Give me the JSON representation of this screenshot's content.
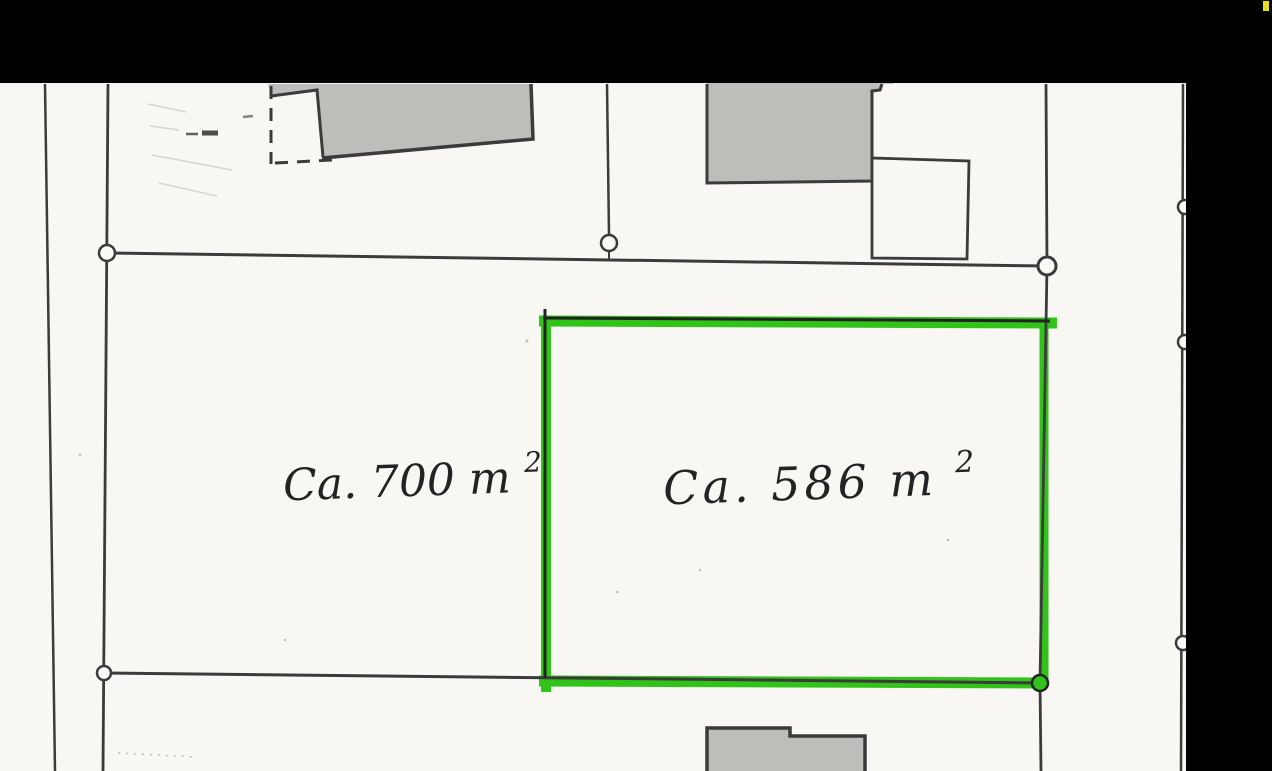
{
  "document": {
    "type_label": "Scanned cadastral site plan with highlighted parcel",
    "parcels": {
      "left": {
        "area_label": "Ca. 700 m",
        "area_sup": "2"
      },
      "right": {
        "area_label": "Ca. 586 m",
        "area_sup": "2",
        "highlighted": true
      }
    }
  },
  "colors": {
    "paper": "#f8f7f3",
    "ink": "#3b3b3b",
    "pen_dark": "#232323",
    "building_fill": "#bdbdba",
    "highlight_green": "#31c31a",
    "scan_black": "#000000",
    "yellow_mark": "#eadf1e",
    "circle_fill": "#fbfaf7"
  }
}
